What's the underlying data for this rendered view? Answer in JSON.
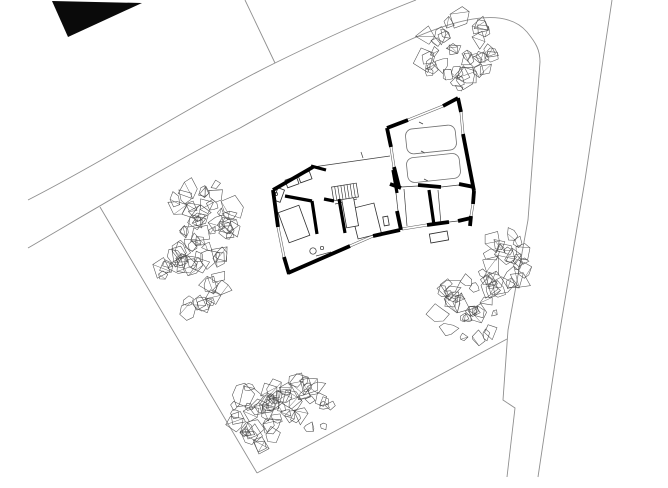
{
  "canvas": {
    "width": 668,
    "height": 488,
    "background": "#ffffff"
  },
  "colors": {
    "wall": "#000000",
    "neighbor_building": "#0a0a0a",
    "site_line": "#8f8f8f",
    "thin_line": "#3f3f3f",
    "window_line": "#5a5a5a",
    "furniture_line": "#2e2e2e",
    "car_line": "#6f6f6f",
    "tree_line": "#4f4f4f"
  },
  "neighbor_building": {
    "points": [
      [
        52,
        1
      ],
      [
        142,
        3
      ],
      [
        68,
        37
      ]
    ]
  },
  "site_lines": [
    {
      "name": "road-upper-edge",
      "d": "M 28,200 C 110,158 200,100 275,63 C 330,36 380,14 416,0"
    },
    {
      "name": "road-lower-edge-with-corner-arc",
      "d": "M 28,248 C 100,206 180,158 240,128 C 300,94 355,66 405,42 C 455,19 505,6 527,32 C 536,43 540,50 540,62"
    },
    {
      "name": "plot-divider-north",
      "d": "M 245,0 L 275,63"
    },
    {
      "name": "west-boundary",
      "d": "M 100,207 L 257,473"
    },
    {
      "name": "south-boundary",
      "d": "M 257,473 L 507,339"
    },
    {
      "name": "east-road-left-edge",
      "d": "M 540,62 L 528,220 L 508,330 L 503,400 L 515,408 L 507,477"
    },
    {
      "name": "east-road-right-edge",
      "d": "M 612,0 L 585,180 L 560,330 L 538,477"
    }
  ],
  "building": {
    "thick_walls": [
      {
        "seg": [
          273,
          190,
          313,
          167
        ]
      },
      {
        "seg": [
          311,
          166,
          326,
          170
        ],
        "w": 3.2
      },
      {
        "seg": [
          273,
          190,
          278,
          227
        ]
      },
      {
        "seg": [
          284,
          257,
          289,
          274
        ]
      },
      {
        "seg": [
          288,
          273,
          350,
          246
        ]
      },
      {
        "seg": [
          373,
          236,
          400,
          230
        ]
      },
      {
        "seg": [
          393,
          170,
          397,
          193
        ],
        "w": 3.2
      },
      {
        "seg": [
          397,
          211,
          401,
          230
        ]
      },
      {
        "seg": [
          285,
          196,
          312,
          201
        ],
        "w": 3.2
      },
      {
        "seg": [
          324,
          199,
          334,
          201
        ],
        "w": 3.2
      },
      {
        "seg": [
          312,
          201,
          317,
          234
        ],
        "w": 3.2
      },
      {
        "seg": [
          339,
          199,
          345,
          233
        ],
        "w": 3.2
      },
      {
        "seg": [
          429,
          190,
          434,
          225
        ],
        "w": 3.2
      },
      {
        "seg": [
          427,
          225,
          449,
          222
        ]
      },
      {
        "seg": [
          458,
          221,
          471,
          218
        ]
      },
      {
        "seg": [
          474,
          191,
          473,
          204
        ]
      },
      {
        "seg": [
          471,
          216,
          470,
          226
        ]
      },
      {
        "seg": [
          390,
          184,
          401,
          188
        ]
      },
      {
        "seg": [
          418,
          185,
          441,
          187
        ]
      },
      {
        "seg": [
          459,
          184,
          474,
          187
        ]
      },
      {
        "seg": [
          387,
          128,
          391,
          147
        ]
      },
      {
        "seg": [
          394,
          167,
          399,
          187
        ]
      },
      {
        "seg": [
          458,
          98,
          443,
          106
        ]
      },
      {
        "seg": [
          408,
          120,
          387,
          128
        ]
      },
      {
        "seg": [
          458,
          98,
          461,
          112
        ]
      },
      {
        "seg": [
          463,
          134,
          474,
          191
        ]
      }
    ],
    "windows": [
      {
        "seg": [
          278,
          227,
          284,
          257
        ]
      },
      {
        "seg": [
          350,
          246,
          373,
          236
        ]
      },
      {
        "seg": [
          443,
          106,
          408,
          120
        ]
      },
      {
        "seg": [
          461,
          112,
          463,
          134
        ]
      },
      {
        "seg": [
          473,
          204,
          471,
          216
        ]
      },
      {
        "seg": [
          391,
          147,
          394,
          167
        ]
      },
      {
        "seg": [
          402,
          229,
          427,
          225
        ]
      }
    ],
    "thin_lines": [
      {
        "seg": [
          313,
          167,
          390,
          156
        ]
      },
      {
        "seg": [
          361,
          152,
          363,
          158
        ]
      },
      {
        "seg": [
          404,
          189,
          407,
          226
        ]
      },
      {
        "seg": [
          438,
          190,
          441,
          224
        ]
      },
      {
        "seg": [
          396,
          193,
          398,
          211
        ]
      },
      {
        "seg": [
          449,
          222,
          458,
          221
        ]
      },
      {
        "seg": [
          401,
          187,
          418,
          186
        ]
      },
      {
        "seg": [
          441,
          187,
          459,
          185
        ]
      },
      {
        "seg": [
          316,
          256,
          331,
          252
        ]
      },
      {
        "seg": [
          335,
          204,
          357,
          199
        ]
      },
      {
        "seg": [
          419,
          122,
          423,
          124
        ]
      },
      {
        "seg": [
          421,
          151,
          425,
          153
        ]
      },
      {
        "seg": [
          424,
          179,
          428,
          181
        ]
      }
    ],
    "stairs": {
      "cx": 345,
      "cy": 192,
      "w": 25,
      "h": 14,
      "rot": -9,
      "steps": 8
    },
    "furniture": [
      {
        "cx": 294,
        "cy": 224,
        "w": 22,
        "h": 32,
        "rot": -20
      },
      {
        "cx": 366,
        "cy": 221,
        "w": 24,
        "h": 31,
        "rot": -14
      },
      {
        "cx": 350,
        "cy": 212,
        "w": 12,
        "h": 30,
        "rot": -10
      },
      {
        "cx": 292,
        "cy": 182,
        "w": 12,
        "h": 8,
        "rot": -20
      },
      {
        "cx": 305,
        "cy": 177,
        "w": 12,
        "h": 8,
        "rot": -20
      },
      {
        "cx": 279,
        "cy": 195,
        "w": 13,
        "h": 7,
        "rot": -70
      },
      {
        "cx": 386,
        "cy": 221,
        "w": 5,
        "h": 9,
        "rot": -10
      },
      {
        "cx": 439,
        "cy": 237,
        "w": 18,
        "h": 9,
        "rot": -10
      }
    ],
    "circles": [
      {
        "cx": 313,
        "cy": 251,
        "r": 3.2
      },
      {
        "cx": 322,
        "cy": 248,
        "r": 1.7
      },
      {
        "cx": 276,
        "cy": 194,
        "r": 1.6
      }
    ],
    "cars": [
      {
        "cx": 431,
        "cy": 139.5,
        "w": 50,
        "h": 25,
        "rot": -6,
        "rx": 7
      },
      {
        "cx": 433.5,
        "cy": 168,
        "w": 53,
        "h": 25,
        "rot": -6,
        "rx": 7
      }
    ]
  },
  "trees": [
    {
      "cx": 207,
      "cy": 216,
      "r": 41,
      "seed": 11
    },
    {
      "cx": 195,
      "cy": 278,
      "r": 40,
      "seed": 22
    },
    {
      "cx": 458,
      "cy": 52,
      "r": 42,
      "seed": 33
    },
    {
      "cx": 503,
      "cy": 262,
      "r": 34,
      "seed": 44
    },
    {
      "cx": 469,
      "cy": 307,
      "r": 38,
      "seed": 55
    },
    {
      "cx": 257,
      "cy": 416,
      "r": 36,
      "seed": 66
    },
    {
      "cx": 299,
      "cy": 408,
      "r": 38,
      "seed": 77
    }
  ]
}
